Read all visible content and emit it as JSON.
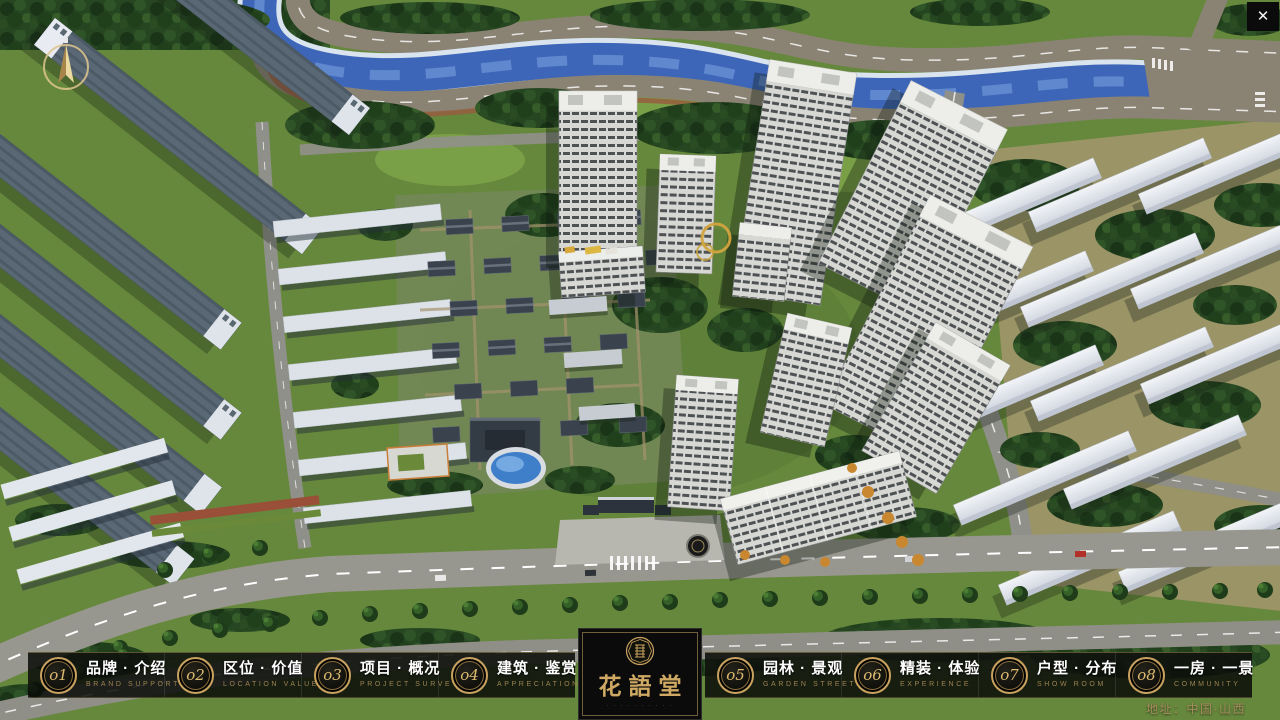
{
  "app": {
    "close_glyph": "✕"
  },
  "colors": {
    "accent_gold": "#c9a25f",
    "nav_text_white": "#ffffff",
    "nav_text_gold": "#9c8250",
    "address_gold": "#a58d5d",
    "river_blue": "#3e66b8",
    "foliage_green": "#264621",
    "road_gray": "#98978f"
  },
  "nav": {
    "items": [
      {
        "num": "o1",
        "zh": "品牌 · 介绍",
        "en": "BRAND SUPPORT"
      },
      {
        "num": "o2",
        "zh": "区位 · 价值",
        "en": "LOCATION VALUE"
      },
      {
        "num": "o3",
        "zh": "项目 · 概况",
        "en": "PROJECT SURVEY"
      },
      {
        "num": "o4",
        "zh": "建筑 · 鉴赏",
        "en": "APPRECIATION"
      },
      {
        "num": "o5",
        "zh": "园林 · 景观",
        "en": "GARDEN STREET"
      },
      {
        "num": "o6",
        "zh": "精装 · 体验",
        "en": "EXPERIENCE"
      },
      {
        "num": "o7",
        "zh": "户型 · 分布",
        "en": "SHOW ROOM"
      },
      {
        "num": "o8",
        "zh": "一房 · 一景",
        "en": "COMMUNITY"
      }
    ]
  },
  "logo": {
    "name": "花語堂",
    "subtitle": "· · · · · · · · · ·"
  },
  "footer": {
    "address": "地址：中国·山西"
  }
}
